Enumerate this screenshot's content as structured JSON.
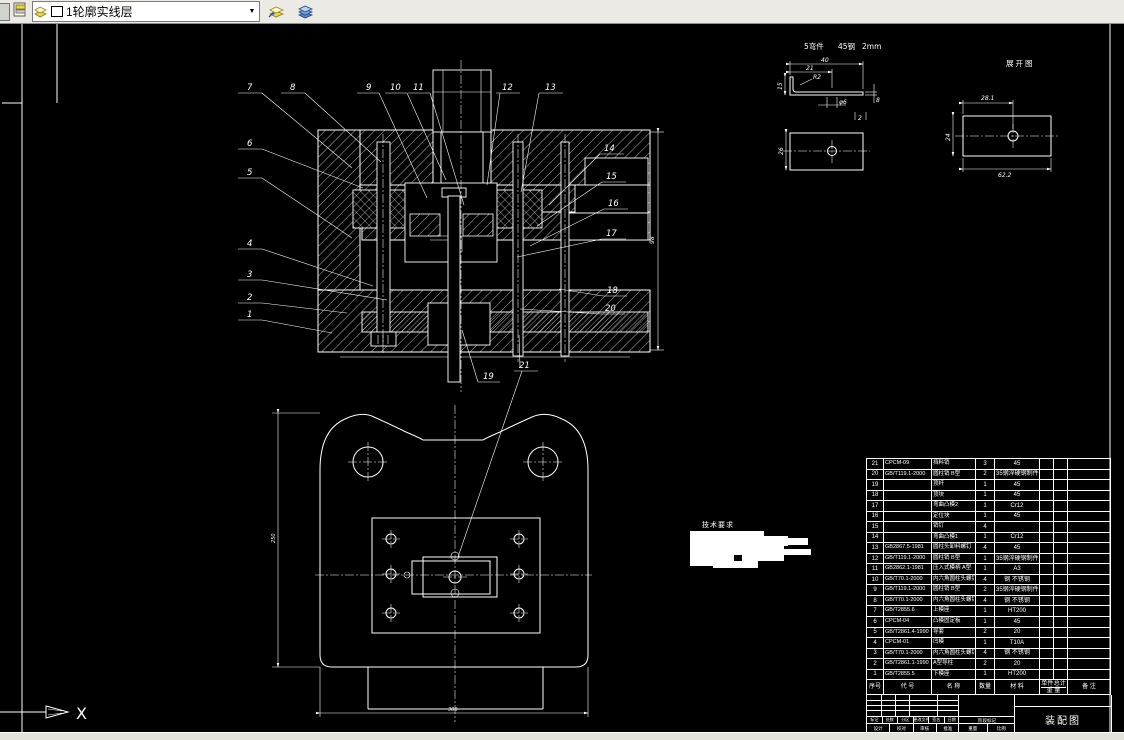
{
  "toolbar": {
    "layer_dropdown_value": "1轮廓实线层",
    "dropdown_arrow": "▼"
  },
  "ucs": {
    "x_label": "X"
  },
  "section_view": {
    "dim_height": "98",
    "balloons": {
      "b1": "1",
      "b2": "2",
      "b3": "3",
      "b4": "4",
      "b5": "5",
      "b6": "6",
      "b7": "7",
      "b8": "8",
      "b9": "9",
      "b10": "10",
      "b11": "11",
      "b12": "12",
      "b13": "13",
      "b14": "14",
      "b15": "15",
      "b16": "16",
      "b17": "17",
      "b18": "18",
      "b19": "19",
      "b20": "20",
      "b21": "21"
    }
  },
  "detail_bent": {
    "part_label": "5弯件",
    "material_label": "45钢",
    "thickness_label": "2mm",
    "dims": {
      "top": "40",
      "mid": "21",
      "radius": "R2",
      "left": "15",
      "hole": "φ6",
      "right": "8",
      "thick": "2",
      "plan_left": "26"
    }
  },
  "detail_unfold": {
    "title": "展开图",
    "dims": {
      "top": "28.1",
      "left": "24",
      "bottom": "62.2"
    }
  },
  "tech_req": {
    "title": "技术要求"
  },
  "plan_view": {
    "dims": {
      "bottom": "300",
      "left": "250"
    }
  },
  "parts_table": {
    "headers": {
      "no": "序号",
      "code": "代  号",
      "name": "名  称",
      "qty": "数量",
      "material": "材  料",
      "weight_unit": "单件",
      "weight_total": "总计",
      "weight_label": "重 量",
      "remark": "备  注"
    },
    "rows": [
      {
        "no": "21",
        "code": "CPCM-09",
        "name": "挡料销",
        "qty": "3",
        "material": "45",
        "remark": ""
      },
      {
        "no": "20",
        "code": "GB/T119.1-2000",
        "name": "圆柱销 B型",
        "qty": "2",
        "material": "35钢淬硬钢制件",
        "remark": ""
      },
      {
        "no": "19",
        "code": "",
        "name": "顶杆",
        "qty": "1",
        "material": "45",
        "remark": ""
      },
      {
        "no": "18",
        "code": "",
        "name": "顶块",
        "qty": "1",
        "material": "45",
        "remark": ""
      },
      {
        "no": "17",
        "code": "",
        "name": "弯曲凸模2",
        "qty": "1",
        "material": "Cr12",
        "remark": ""
      },
      {
        "no": "16",
        "code": "",
        "name": "定位块",
        "qty": "1",
        "material": "45",
        "remark": ""
      },
      {
        "no": "15",
        "code": "",
        "name": "销钉",
        "qty": "4",
        "material": "",
        "remark": ""
      },
      {
        "no": "14",
        "code": "",
        "name": "弯曲凸模1",
        "qty": "1",
        "material": "Cr12",
        "remark": ""
      },
      {
        "no": "13",
        "code": "GB2867.5-1981",
        "name": "圆柱头卸料螺钉",
        "qty": "4",
        "material": "45",
        "remark": ""
      },
      {
        "no": "12",
        "code": "GB/T119.1-2000",
        "name": "圆柱销 B型",
        "qty": "1",
        "material": "35钢淬硬钢制件",
        "remark": ""
      },
      {
        "no": "11",
        "code": "GB2862.1-1981",
        "name": "压入式模柄 A型",
        "qty": "1",
        "material": "A3",
        "remark": ""
      },
      {
        "no": "10",
        "code": "GB/T70.1-2000",
        "name": "内六角圆柱头螺钉",
        "qty": "4",
        "material": "钢 不锈钢",
        "remark": ""
      },
      {
        "no": "9",
        "code": "GB/T119.1-2000",
        "name": "圆柱销 B型",
        "qty": "2",
        "material": "35钢淬硬钢制件",
        "remark": ""
      },
      {
        "no": "8",
        "code": "GB/T70.1-2000",
        "name": "内六角圆柱头螺钉",
        "qty": "4",
        "material": "钢 不锈钢",
        "remark": ""
      },
      {
        "no": "7",
        "code": "GB/T2855.6",
        "name": "上模座",
        "qty": "1",
        "material": "HT200",
        "remark": ""
      },
      {
        "no": "6",
        "code": "CPCM-04",
        "name": "凸模固定板",
        "qty": "1",
        "material": "45",
        "remark": ""
      },
      {
        "no": "5",
        "code": "GB/T2861.4-1990",
        "name": "导套",
        "qty": "2",
        "material": "20",
        "remark": ""
      },
      {
        "no": "4",
        "code": "CPCM-01",
        "name": "凹模",
        "qty": "1",
        "material": "T10A",
        "remark": ""
      },
      {
        "no": "3",
        "code": "GB/T70.1-2000",
        "name": "内六角圆柱头螺钉",
        "qty": "4",
        "material": "钢 不锈钢",
        "remark": ""
      },
      {
        "no": "2",
        "code": "GB/T2861.1-1990",
        "name": "A型导柱",
        "qty": "2",
        "material": "20",
        "remark": ""
      },
      {
        "no": "1",
        "code": "GB/T2855.5",
        "name": "下模座",
        "qty": "1",
        "material": "HT200",
        "remark": ""
      }
    ]
  },
  "title_block": {
    "drawing_name": "装配图",
    "revision_labels": [
      "标记",
      "处数",
      "分区",
      "更改文件号",
      "签名",
      "日期"
    ],
    "sign_labels": [
      "设计",
      "校对",
      "审核",
      "批准"
    ],
    "stage_label": "阶段标记",
    "weight_label": "重量",
    "scale_label": "比例"
  }
}
